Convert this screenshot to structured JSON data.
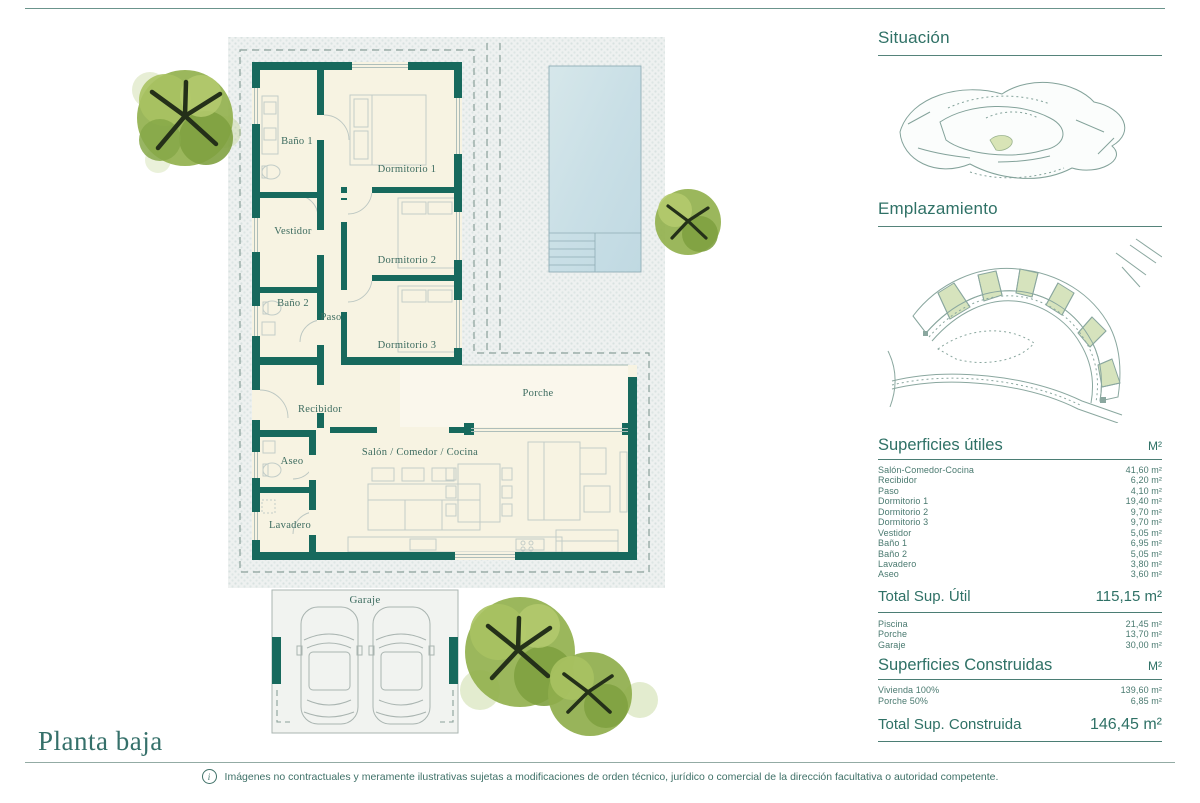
{
  "page": {
    "title": "Planta baja",
    "disclaimer": "Imágenes no contractuales y meramente ilustrativas sujetas a modificaciones de orden técnico, jurídico o comercial de la dirección facultativa o autoridad competente.",
    "info_glyph": "i"
  },
  "floorplan": {
    "rooms": {
      "bano1": "Baño 1",
      "dormitorio1": "Dormitorio 1",
      "vestidor": "Vestidor",
      "dormitorio2": "Dormitorio 2",
      "bano2": "Baño 2",
      "paso": "Paso",
      "dormitorio3": "Dormitorio 3",
      "recibidor": "Recibidor",
      "porche": "Porche",
      "aseo": "Aseo",
      "salon": "Salón / Comedor / Cocina",
      "lavadero": "Lavadero",
      "garaje": "Garaje"
    }
  },
  "panel": {
    "situacion_title": "Situación",
    "emplazamiento_title": "Emplazamiento",
    "utiles": {
      "title": "Superficies útiles",
      "unit": "M²",
      "rows": [
        {
          "label": "Salón-Comedor-Cocina",
          "value": "41,60 m²"
        },
        {
          "label": "Recibidor",
          "value": "6,20 m²"
        },
        {
          "label": "Paso",
          "value": "4,10 m²"
        },
        {
          "label": "Dormitorio 1",
          "value": "19,40 m²"
        },
        {
          "label": "Dormitorio 2",
          "value": "9,70 m²"
        },
        {
          "label": "Dormitorio 3",
          "value": "9,70 m²"
        },
        {
          "label": "Vestidor",
          "value": "5,05 m²"
        },
        {
          "label": "Baño 1",
          "value": "6,95 m²"
        },
        {
          "label": "Baño 2",
          "value": "5,05 m²"
        },
        {
          "label": "Lavadero",
          "value": "3,80 m²"
        },
        {
          "label": "Aseo",
          "value": "3,60 m²"
        }
      ],
      "total_label": "Total Sup. Útil",
      "total_value": "115,15 m²"
    },
    "exteriores_rows": [
      {
        "label": "Piscina",
        "value": "21,45 m²"
      },
      {
        "label": "Porche",
        "value": "13,70 m²"
      },
      {
        "label": "Garaje",
        "value": "30,00 m²"
      }
    ],
    "construidas": {
      "title": "Superficies Construidas",
      "unit": "M²",
      "rows": [
        {
          "label": "Vivienda 100%",
          "value": "139,60 m²"
        },
        {
          "label": "Porche 50%",
          "value": "6,85 m²"
        }
      ],
      "total_label": "Total Sup. Construida",
      "total_value": "146,45 m²"
    }
  },
  "colors": {
    "wall": "#17695d",
    "accent_text": "#2f7166",
    "floor": "#f7f3e2",
    "pool": "#c9dfe6",
    "plot_dot": "#d8e2e0",
    "parcel_green": "#d6e3bd",
    "tree_green": "#93b14e"
  }
}
